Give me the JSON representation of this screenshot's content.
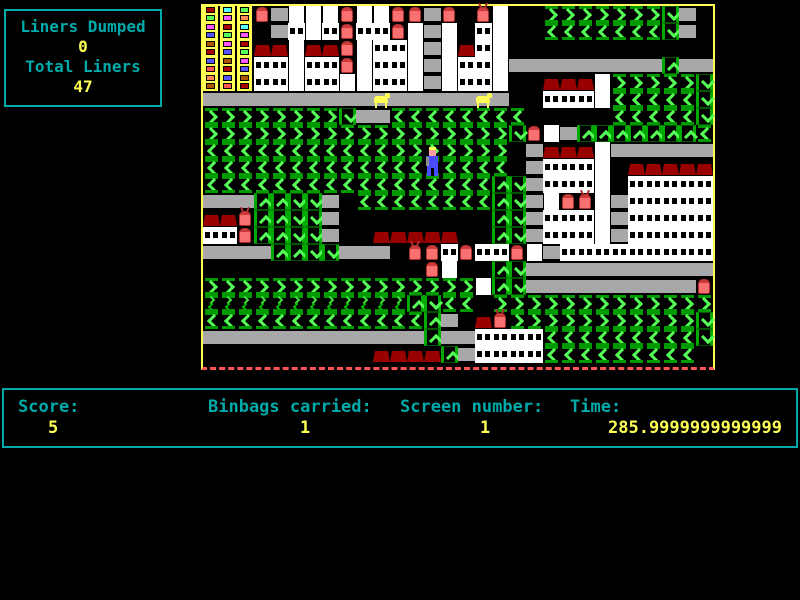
{
  "info_panel": {
    "liners_dumped_label": "Liners Dumped",
    "liners_dumped_value": "0",
    "total_liners_label": "Total Liners",
    "total_liners_value": "47"
  },
  "status_bar": {
    "score_label": "Score:",
    "score_value": "5",
    "binbags_label": "Binbags carried:",
    "binbags_value": "1",
    "screen_label": "Screen number:",
    "screen_value": "1",
    "time_label": "Time:",
    "time_value": "285.9999999999999"
  },
  "colors": {
    "hud_cyan": "#00aaaa",
    "hud_yellow": "#ffff55",
    "border_yellow": "#ffff55",
    "border_dash_red": "#ff5555",
    "conveyor_green": "#55ff55",
    "conveyor_dark_green": "#009900",
    "road_gray": "#a8a8a8",
    "roof_red": "#990000",
    "bin_red": "#f87070",
    "bin_lid_red": "#cc3a3a",
    "player_blue": "#4a4aff",
    "depot_palette": [
      "#aa0000",
      "#5555ff",
      "#55ff55",
      "#ff55ff",
      "#ff8855",
      "#55ffff",
      "#aa5500",
      "#ff5555"
    ]
  },
  "game": {
    "legend": {
      ">": "conveyor-right",
      "<": "conveyor-left",
      "^": "conveyor-up",
      "v": "conveyor-down",
      "=": "road",
      "W": "building-wall-windows",
      "w": "building-wall",
      "R": "building-roof",
      "b": "red-bin",
      "B": "red-bin-creature",
      "D": "depot-tower",
      "Y": "yellow-dog",
      "m": "mini-conveyor-pair",
      "P": "player",
      ".": "empty"
    },
    "grid": [
      "DDDb=wwwbwwbb=b.Bw..>>>>>>>v=.",
      "DDD.=WwWbWWbw=w.Ww..<<<<<<<v=.",
      "DDDRRwRRbwWWw=wRWw............",
      "DDDWWwWWbwWWw=wWWw=========^==",
      "DDDWWwWWwwWWw=wWWw..RRRw>>>>>v",
      "==========Y=====Y=..WWWw<<<<<v",
      ">>>>>>>>v==<<<<<<<<.....<<<<<v",
      ">>>>>>>>>>>>>>>>>>vbw=^^^^^^^<",
      "<<<<<<<<<<<>>>>>>>.=RRRw======",
      "<<<<<<<<<<<<<P<<<<.=WWWw.RRRRR",
      "<<<<<<<<<<<<<<<<<^v=WWWw.WWWWW",
      "===^^vv=.<<<<<<<<^v=wbBw=WWWWW",
      "RRB^^vv=.........^v=WWWw=WWWWW",
      "WWb^^vv=..RRRRR..^v=WWWw=WWWWW",
      "====^^vv===.BbWbWWbw=WWWWWWWWW",
      ".............bw..^v===========",
      ">>>>>>>>>>>>>>>>w^v==========b",
      "mmmmmmmmmmmm^v<<.>>>>>>>>>>>>>",
      "<<<<<<<<<<<<<^=.RB>>>>>>>>>>>v",
      "=============^==WWWW<<<<<<<<<v",
      "..........RRRR^=WWWW<<<<<<<<<."
    ]
  }
}
